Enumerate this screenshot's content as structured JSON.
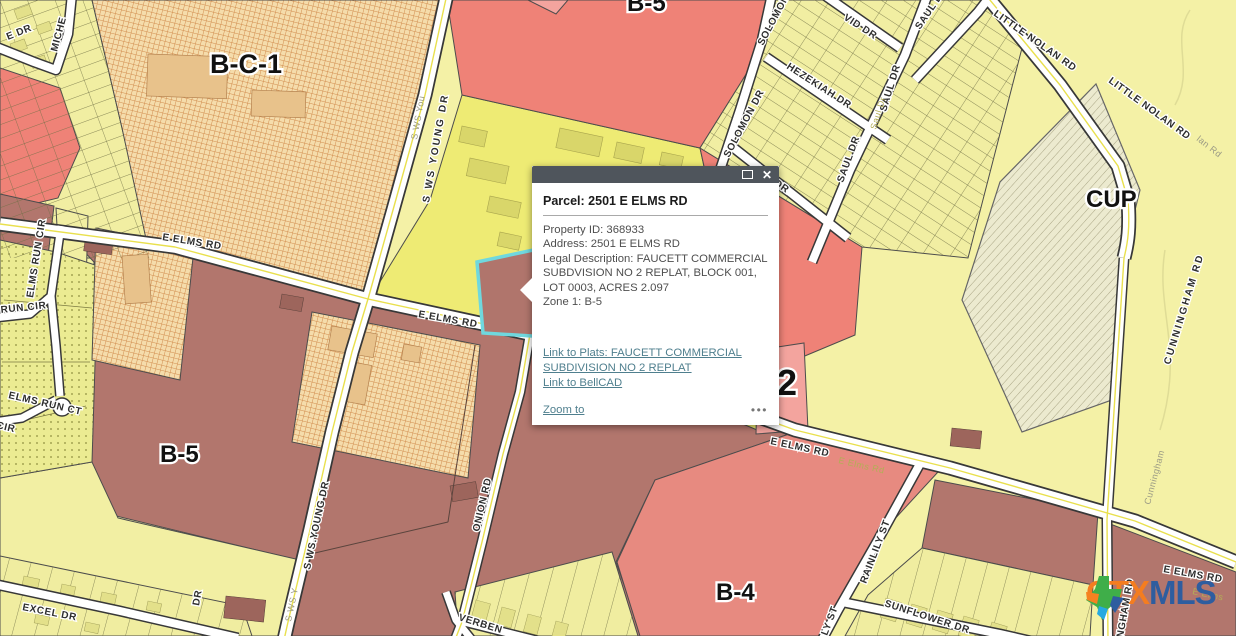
{
  "popup": {
    "title": "Parcel: 2501 E ELMS RD",
    "close_glyph": "✕",
    "fields": [
      "Property ID:  368933",
      "Address:  2501 E ELMS RD",
      "Legal Description: FAUCETT COMMERCIAL SUBDVISION NO 2 REPLAT, BLOCK 001, LOT 0003, ACRES 2.097",
      "Zone 1:  B-5"
    ],
    "link_plats": "Link to Plats: FAUCETT COMMERCIAL SUBDIVISION NO 2 REPLAT",
    "link_bellcad": "Link to BellCAD",
    "zoom_to": "Zoom to",
    "more": "•••"
  },
  "map": {
    "zone_labels": [
      {
        "label": "B-C-1"
      },
      {
        "label": "B-5"
      },
      {
        "label": "CUP"
      },
      {
        "label": "B-5"
      },
      {
        "label": "B-4"
      },
      {
        "label": "2"
      }
    ],
    "street_labels": [
      {
        "label": "E DR"
      },
      {
        "label": "MICHE"
      },
      {
        "label": "ELMS RUN CIR"
      },
      {
        "label": "RUN CIR"
      },
      {
        "label": "ELMS RUN CT"
      },
      {
        "label": "CIR"
      },
      {
        "label": "EXCEL DR"
      },
      {
        "label": "E ELMS RD"
      },
      {
        "label": "E ELMS RD"
      },
      {
        "label": "E ELMS RD"
      },
      {
        "label": "E Elms Rd"
      },
      {
        "label": "E ELMS RD"
      },
      {
        "label": "E Elms"
      },
      {
        "label": "S WS YOUNG DR"
      },
      {
        "label": "S WS You"
      },
      {
        "label": "S WS.YOUNG DR"
      },
      {
        "label": "S WS Y"
      },
      {
        "label": "ONION RD"
      },
      {
        "label": "VERBEN"
      },
      {
        "label": "DR"
      },
      {
        "label": "SOLOMON DR"
      },
      {
        "label": "SOLOMON DR"
      },
      {
        "label": "HEZEKIAH DR"
      },
      {
        "label": "ASA DR"
      },
      {
        "label": "SAUL DR"
      },
      {
        "label": "SAUL DR"
      },
      {
        "label": "SAUL D"
      },
      {
        "label": "VID DR"
      },
      {
        "label": "Saul Dr"
      },
      {
        "label": "LITTLE NOLAN RD"
      },
      {
        "label": "LITTLE NOLAN RD"
      },
      {
        "label": "lan Rd"
      },
      {
        "label": "CUNNINGHAM RD"
      },
      {
        "label": "Cunningham"
      },
      {
        "label": "NGHAM RD"
      },
      {
        "label": "RAINLILY ST"
      },
      {
        "label": "LY ST"
      },
      {
        "label": "SUNFLOWER DR"
      }
    ]
  },
  "logo": {
    "ctx": "CTX",
    "mls": "MLS"
  },
  "colors": {
    "selected_parcel_outline": "#6fd8de",
    "popup_titlebar": "#4f555c",
    "link": "#4f7f8e",
    "zone_b5_salmon": "#ef8277",
    "zone_b5_maroon": "#b2766d",
    "zone_b4": "#e78a80",
    "zone_bc1_hatch": "#d18c4e",
    "residential_yellow": "#f1eea2",
    "cup_fill": "#eceacf"
  }
}
